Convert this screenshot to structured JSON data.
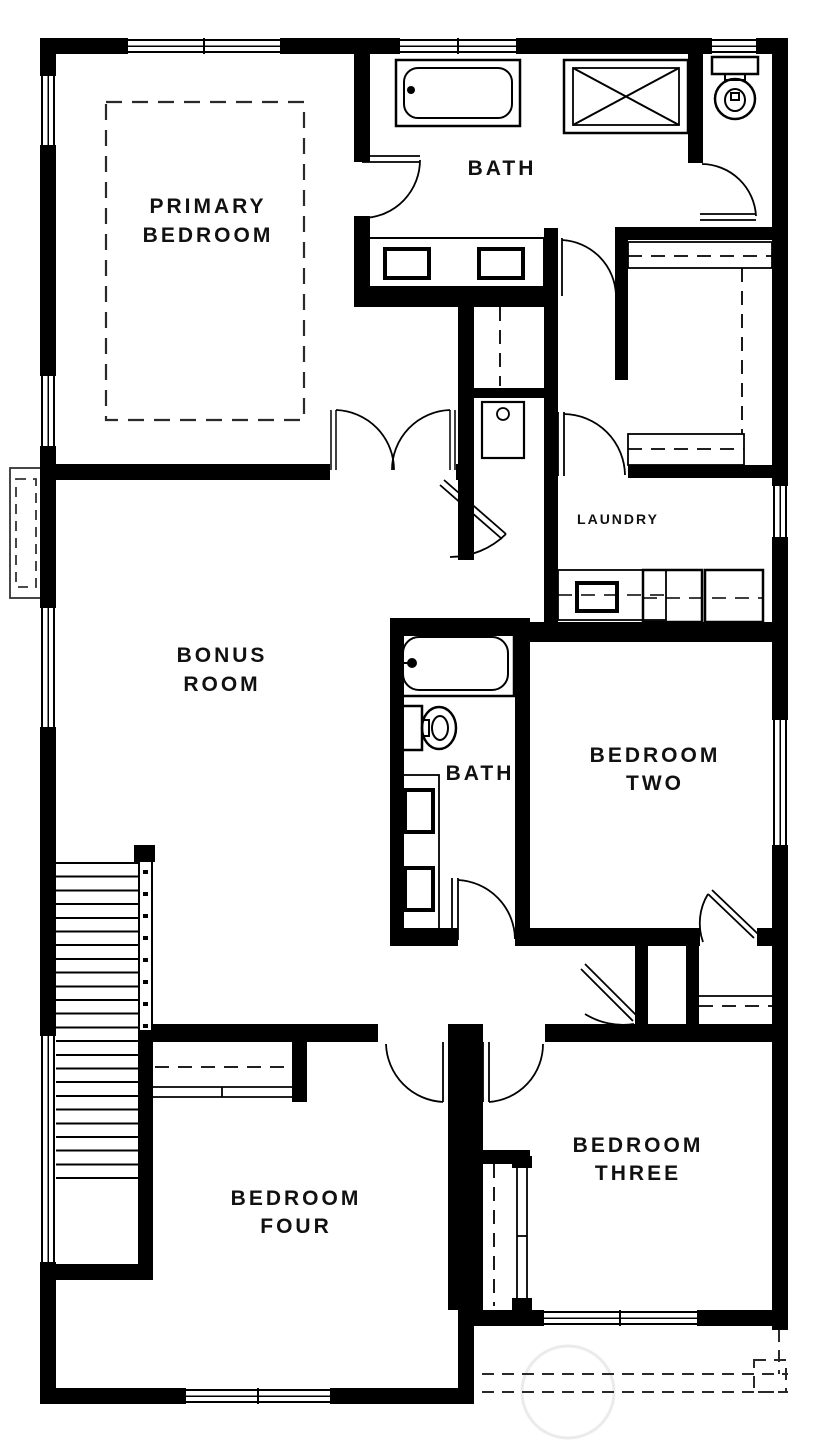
{
  "floorplan": {
    "canvas": {
      "width": 836,
      "height": 1440
    },
    "colors": {
      "wall": "#000000",
      "line": "#111111",
      "dashed": "#2a2a2a",
      "background": "#ffffff",
      "watermark": "#ebebeb"
    },
    "rooms": {
      "primary_bedroom": {
        "line1": "PRIMARY",
        "line2": "BEDROOM"
      },
      "bath_top": {
        "label": "BATH"
      },
      "laundry": {
        "label": "LAUNDRY"
      },
      "bonus_room": {
        "line1": "BONUS",
        "line2": "ROOM"
      },
      "bath_middle": {
        "label": "BATH"
      },
      "bedroom_two": {
        "line1": "BEDROOM",
        "line2": "TWO"
      },
      "bedroom_three": {
        "line1": "BEDROOM",
        "line2": "THREE"
      },
      "bedroom_four": {
        "line1": "BEDROOM",
        "line2": "FOUR"
      }
    },
    "fixtures": [
      "bathtub-top",
      "shower",
      "toilet-top",
      "double-sink-vanity-top",
      "utility-sink",
      "bathtub-middle",
      "toilet-middle",
      "double-sink-vanity-middle",
      "laundry-sink",
      "washer",
      "dryer",
      "bed-outline",
      "stairs",
      "closet-rods",
      "chimney"
    ]
  }
}
